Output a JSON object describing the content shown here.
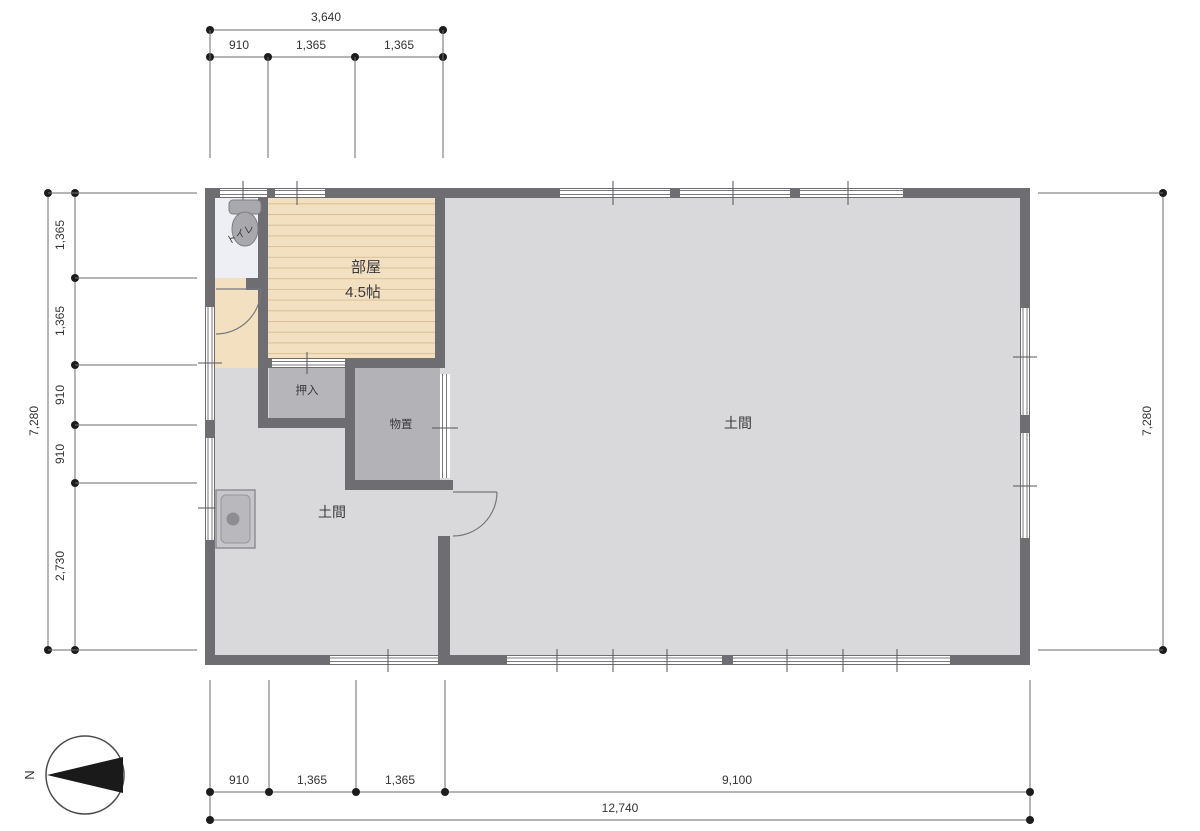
{
  "plan": {
    "rooms": {
      "toilet": {
        "label": "トイレ"
      },
      "room": {
        "label": "部屋",
        "size": "4.5帖"
      },
      "closet": {
        "label": "押入"
      },
      "storage": {
        "label": "物置"
      },
      "doma_left": {
        "label": "土間"
      },
      "doma_main": {
        "label": "土間"
      }
    },
    "dimensions": {
      "top": {
        "overall": "3,640",
        "segments": [
          "910",
          "1,365",
          "1,365"
        ]
      },
      "left": {
        "overall": "7,280",
        "segments": [
          "1,365",
          "1,365",
          "910",
          "910",
          "2,730"
        ]
      },
      "right": {
        "overall": "7,280"
      },
      "bottom": {
        "overall": "12,740",
        "segments": [
          "910",
          "1,365",
          "1,365",
          "9,100"
        ]
      }
    },
    "compass": {
      "north": "N"
    },
    "colors": {
      "wall": "#6d6d72",
      "floor_doma": "#d9d9db",
      "floor_room": "#f2e0c1",
      "floor_toilet": "#edeff5",
      "closet_fill": "#b6b6ba"
    }
  }
}
